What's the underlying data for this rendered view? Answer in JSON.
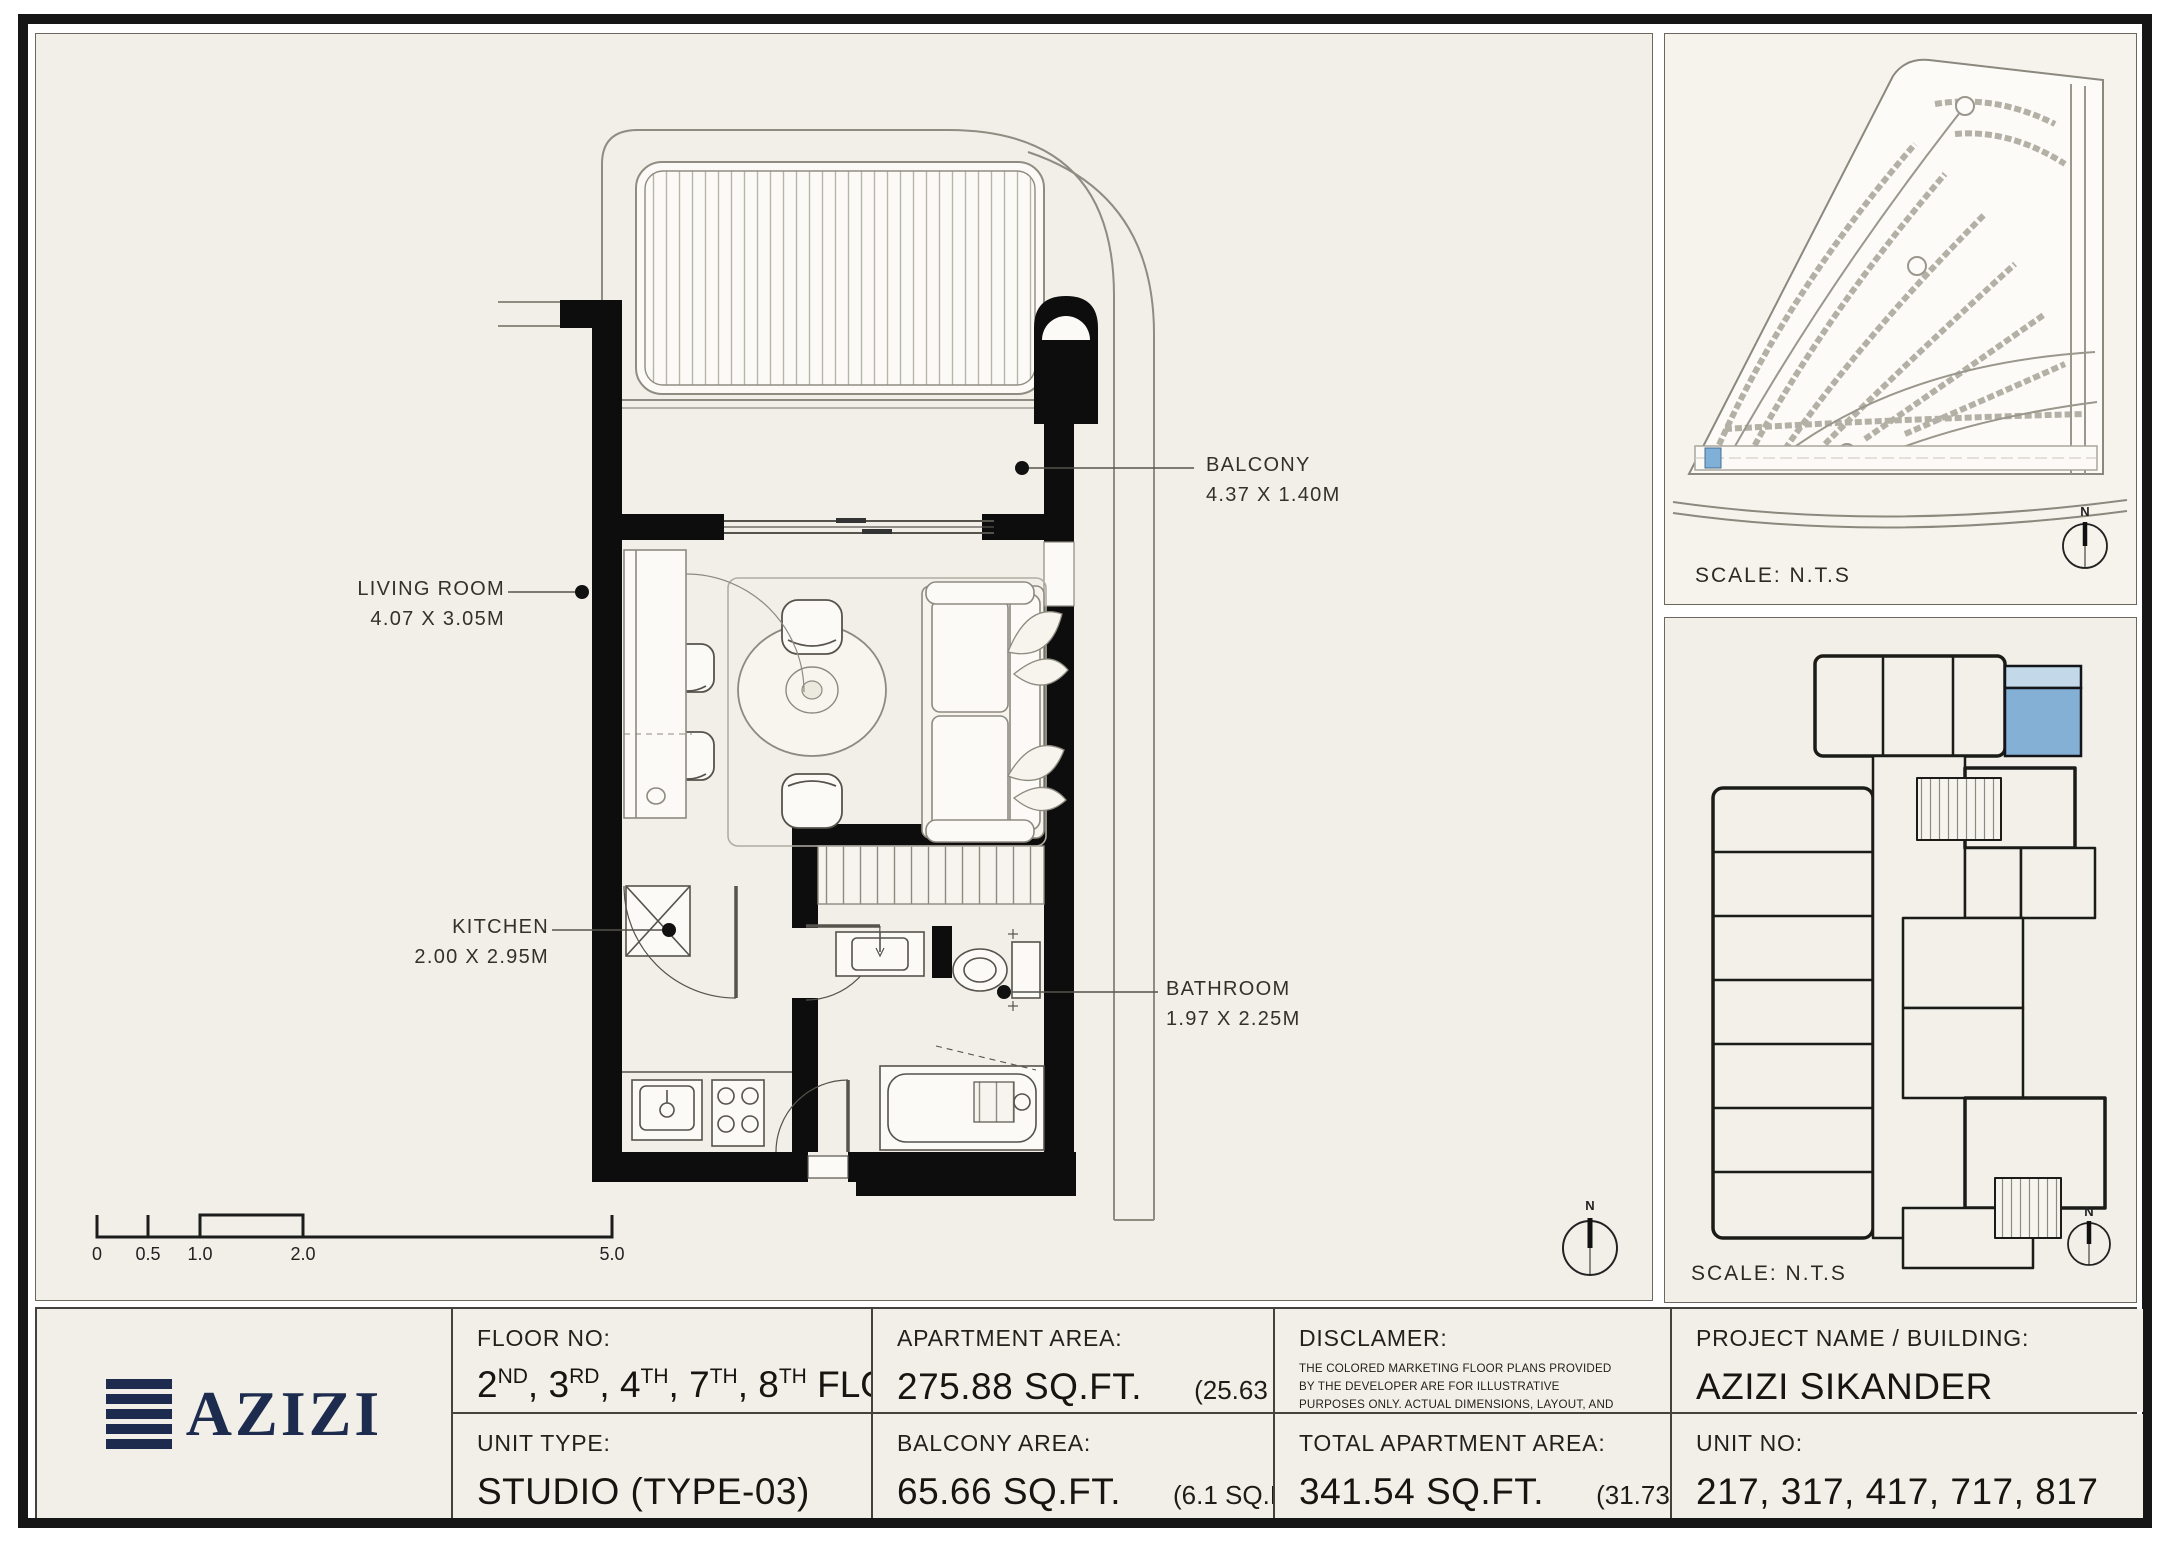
{
  "plan": {
    "rooms": [
      {
        "name": "BALCONY",
        "dims": "4.37 X 1.40M"
      },
      {
        "name": "LIVING ROOM",
        "dims": "4.07 X 3.05M"
      },
      {
        "name": "KITCHEN",
        "dims": "2.00 X 2.95M"
      },
      {
        "name": "BATHROOM",
        "dims": "1.97 X 2.25M"
      }
    ],
    "scale_bar_ticks": [
      "0",
      "0.5",
      "1.0",
      "2.0",
      "5.0"
    ],
    "north_label": "N"
  },
  "site_panel": {
    "scale_text": "SCALE: N.T.S"
  },
  "key_panel": {
    "scale_text": "SCALE: N.T.S",
    "highlight_color": "#85b0d6",
    "highlight_light": "#c3d9ea"
  },
  "footer": {
    "floor": {
      "label": "FLOOR NO:",
      "parts": [
        {
          "num": "2",
          "suffix": "ND"
        },
        {
          "num": "3",
          "suffix": "RD"
        },
        {
          "num": "4",
          "suffix": "TH"
        },
        {
          "num": "7",
          "suffix": "TH"
        },
        {
          "num": "8",
          "suffix": "TH"
        }
      ],
      "tail": "FLOOR"
    },
    "unit_type": {
      "label": "UNIT TYPE:",
      "value": "STUDIO (TYPE-03)"
    },
    "apartment_area": {
      "label": "APARTMENT AREA:",
      "value": "275.88 SQ.FT.",
      "metric": "(25.63 SQ.M)"
    },
    "balcony_area": {
      "label": "BALCONY AREA:",
      "value": "65.66 SQ.FT.",
      "metric": "(6.1 SQ.M)"
    },
    "disclaimer": {
      "label": "DISCLAMER:",
      "text": "THE COLORED MARKETING FLOOR PLANS PROVIDED BY THE DEVELOPER ARE FOR ILLUSTRATIVE PURPOSES ONLY. ACTUAL DIMENSIONS, LAYOUT, AND FINISHES MAY VARY FROM THOSE DEPICTED IN THE PLANS. FURNITURE, FIXTURES, AND EQUIPMENT SHOWN IN THE PLANS ARE FOR DECORATIVE PURPOSES ONLY AND ARE NOT INCLUDED IN THE PURCHASE OR LEASE OF THE PROPERTY. THE DEVELOPER RESERVES THE RIGHT TO MAKE MODIFICATIONS, REVISIONS, AND CHANGES TO THE FLOOR PLANS, SPECIFICATIONS, AND FEATURES WITHOUT PRIOR NOTICE."
    },
    "total_area": {
      "label": "TOTAL APARTMENT AREA:",
      "value": "341.54 SQ.FT.",
      "metric": "(31.73 SQ.M)"
    },
    "project": {
      "label": "PROJECT NAME / BUILDING:",
      "value": "AZIZI SIKANDER"
    },
    "unit_no": {
      "label": "UNIT NO:",
      "value": "217, 317, 417, 717, 817"
    },
    "logo": {
      "text": "AZIZI"
    }
  }
}
